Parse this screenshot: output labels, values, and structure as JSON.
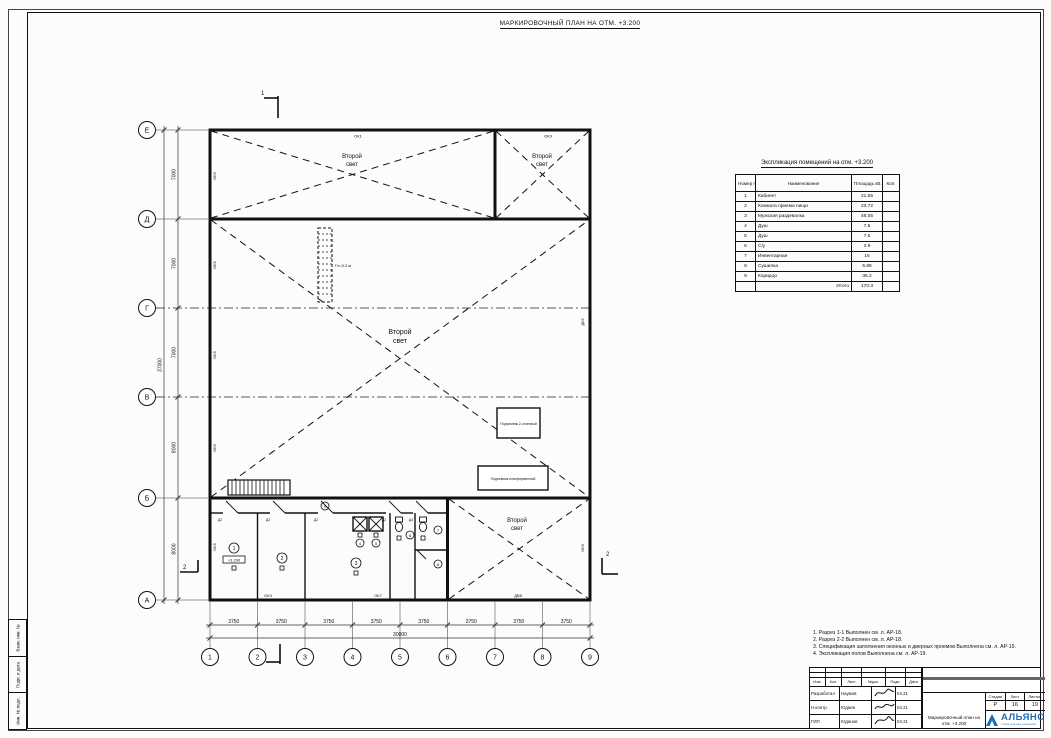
{
  "sheet": {
    "title": "МАРКИРОВОЧНЫЙ ПЛАН НА ОТМ. +3.200"
  },
  "margin_labels": [
    "Взам. инв. №",
    "Подп. и дата",
    "Инв. № подл."
  ],
  "plan": {
    "axes_cols": [
      "1",
      "2",
      "3",
      "4",
      "5",
      "6",
      "7",
      "8",
      "9"
    ],
    "axes_rows": [
      "Е",
      "Д",
      "Г",
      "В",
      "Б",
      "А"
    ],
    "dims_bottom": {
      "bay": "3750",
      "total": "30000"
    },
    "dims_left": {
      "bays": [
        "7000",
        "7000",
        "7000",
        "8000",
        "8000"
      ],
      "total": "37000"
    },
    "second_light": {
      "line1": "Второй",
      "line2": "свет"
    },
    "pit_label": "Гл=3.2 м",
    "equipment": [
      "Подъемник 2-стоечный",
      "Подъемник платформенный"
    ],
    "elevation_mark": "+3.200",
    "sections": {
      "s1": "1",
      "s2": "2"
    },
    "wall_tags": {
      "ok1": "ОК1",
      "ok3": "ОК3",
      "ok4": "ОК4",
      "ok5": "ОК5",
      "ok6": "ОК6",
      "ok7": "ОК7",
      "dk3": "ДК3",
      "dv8": "ДВ8"
    },
    "door_tags": [
      "Д2",
      "Д3",
      "Д2",
      "Д2",
      "Д3"
    ],
    "room_numbers": [
      "1",
      "2",
      "3",
      "4",
      "5",
      "6",
      "7",
      "8",
      "9"
    ]
  },
  "explication": {
    "title": "Экспликация помещений на отм. +3.200",
    "headers": [
      "Номер пом.",
      "Наименование",
      "Площадь кВ.м",
      "Кол."
    ],
    "rows": [
      {
        "num": "1",
        "name": "Кабинет",
        "area": "21.55"
      },
      {
        "num": "2",
        "name": "Комната приема пищи",
        "area": "23.72"
      },
      {
        "num": "3",
        "name": "Мужская раздевалка",
        "area": "48.05"
      },
      {
        "num": "4",
        "name": "Душ",
        "area": "7.5"
      },
      {
        "num": "5",
        "name": "Душ",
        "area": "7.5"
      },
      {
        "num": "6",
        "name": "С/у",
        "area": "3.9"
      },
      {
        "num": "7",
        "name": "Инвентарная",
        "area": "16"
      },
      {
        "num": "8",
        "name": "Сушилка",
        "area": "5.88"
      },
      {
        "num": "9",
        "name": "Коридор",
        "area": "36.2"
      }
    ],
    "total_label": "Итого",
    "total_area": "170.3"
  },
  "notes": {
    "lines": [
      "1. Разрез 1-1 Выполнен см. л. АР-18.",
      "2. Разрез 2-2 Выполнен см. л. АР-18.",
      "3. Спецификация заполнения оконных и дверных проемов Выполнена см. л. АР-19.",
      "4. Экспликация полов Выполнена см. л. АР-19."
    ]
  },
  "stamp": {
    "header_cells": [
      "Изм.",
      "Кол.",
      "Лист",
      "№док.",
      "Подп.",
      "Дата"
    ],
    "rows": [
      {
        "role": "Разработал",
        "name": "Наумов",
        "date": "04.21"
      },
      {
        "role": "Н.контр.",
        "name": "Юдаев",
        "date": "04.21"
      },
      {
        "role": "ГИП",
        "name": "Юданов",
        "date": "04.21"
      }
    ],
    "stage_label": "Стадия",
    "sheet_label": "Лист",
    "sheets_label": "Листов",
    "stage": "Р",
    "sheet_no": "16",
    "sheets_total": "19",
    "doc_title": "Маркировочный план на отм. +3.200",
    "company": "АЛЬЯНС",
    "company_sub": "строительная компания",
    "brand_color": "#1f6cb5"
  }
}
